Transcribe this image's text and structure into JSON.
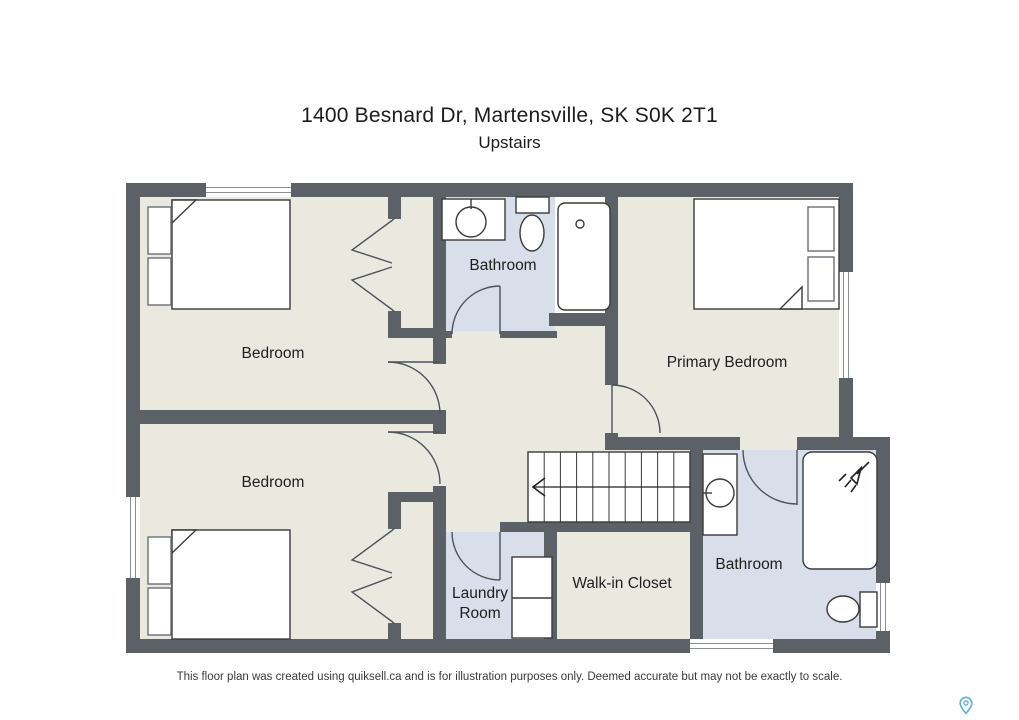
{
  "header": {
    "title": "1400 Besnard Dr, Martensville, SK S0K 2T1",
    "subtitle": "Upstairs"
  },
  "rooms": {
    "bedroom_top": {
      "label": "Bedroom"
    },
    "bedroom_bottom": {
      "label": "Bedroom"
    },
    "bathroom_top": {
      "label": "Bathroom"
    },
    "primary_bedroom": {
      "label": "Primary Bedroom"
    },
    "laundry_room": {
      "label": "Laundry Room"
    },
    "walk_in_closet": {
      "label": "Walk-in Closet"
    },
    "bathroom_bottom": {
      "label": "Bathroom"
    }
  },
  "fixtures": {
    "icons": [
      "bed-icon",
      "nightstand-icon",
      "pillow-icon",
      "toilet-icon",
      "sink-vanity-icon",
      "bathtub-icon",
      "shower-icon",
      "washer-dryer-icon",
      "staircase-icon",
      "door-swing-icon",
      "bifold-closet-door-icon",
      "window-icon",
      "map-pin-icon"
    ],
    "staircase_direction": "down-left-arrow"
  },
  "colors": {
    "wall": "#5c6167",
    "floor": "#eae9e0",
    "wet_floor": "#d8deea",
    "furniture_outline": "#3a3a3a",
    "pin_accent": "#66b2d8"
  },
  "footer": {
    "disclaimer": "This floor plan was created using quiksell.ca and is for illustration purposes only. Deemed accurate but may not be exactly to scale."
  }
}
